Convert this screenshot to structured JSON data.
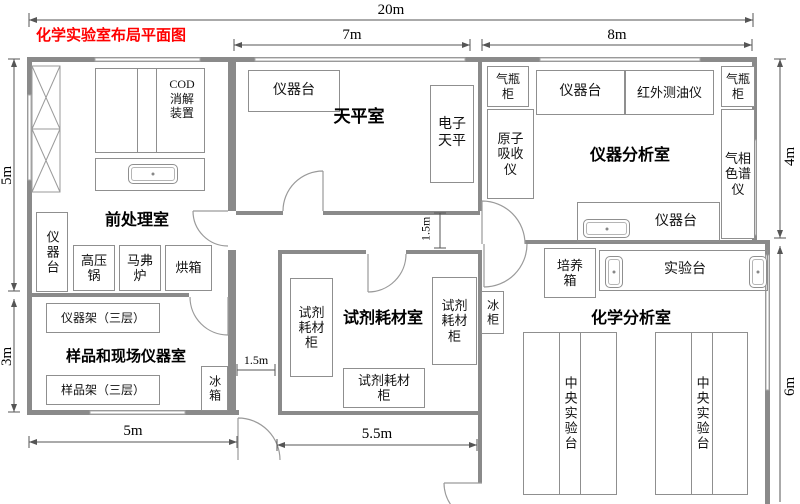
{
  "title": "化学实验室布局平面图",
  "dims": {
    "total_w": "20m",
    "balance_w": "7m",
    "instrument_w": "8m",
    "pretreat_h": "5m",
    "sample_h": "3m",
    "instrument_h": "4m",
    "chem_h": "6m",
    "sample_w": "5m",
    "reagent_w": "5.5m",
    "corridor_w": "1.5m",
    "corridor_h": "1.5m"
  },
  "rooms": {
    "pretreatment": {
      "label": "前处理室",
      "cod": "COD\n消解\n装置",
      "bench": "仪器台",
      "autoclave": "高压\n锅",
      "muffle": "马弗\n炉",
      "oven": "烘箱"
    },
    "sample": {
      "label": "样品和现场仪器室",
      "rack_top": "仪器架（三层）",
      "rack_bottom": "样品架（三层）",
      "fridge": "冰箱"
    },
    "balance": {
      "label": "天平室",
      "bench": "仪器台",
      "balance": "电子\n天平"
    },
    "reagent": {
      "label": "试剂耗材室",
      "cab_left": "试剂\n耗材\n柜",
      "cab_right": "试剂\n耗材\n柜",
      "cab_bottom": "试剂耗材\n柜"
    },
    "instrument": {
      "label": "仪器分析室",
      "gas_left": "气瓶\n柜",
      "aas": "原子\n吸收\n仪",
      "bench_top": "仪器台",
      "oil": "红外测油仪",
      "gas_right": "气瓶\n柜",
      "gc": "气相\n色谱\n仪",
      "bench_bottom": "仪器台"
    },
    "chemical": {
      "label": "化学分析室",
      "incubator": "培养\n箱",
      "bench": "实验台",
      "freezer": "冰柜",
      "central_left": "中央实验台",
      "central_right": "中央实验台"
    }
  }
}
